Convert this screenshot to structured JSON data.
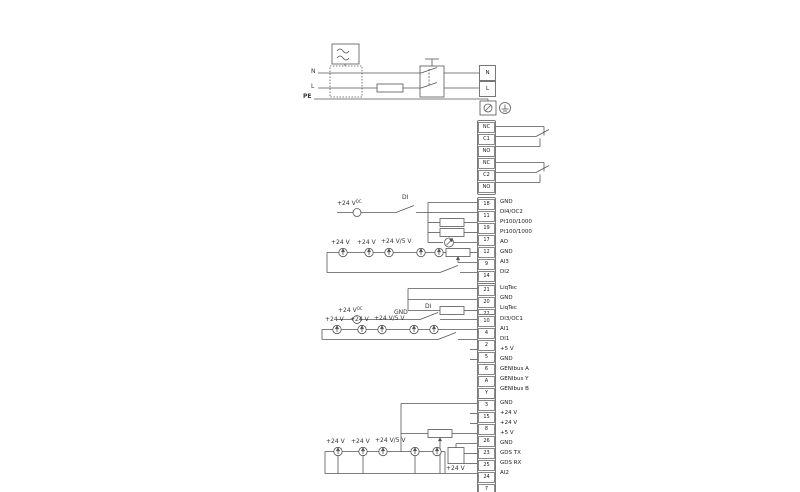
{
  "colors": {
    "line": "#555555",
    "box_border": "#7a7a7a",
    "text": "#222222",
    "background": "#ffffff"
  },
  "power": {
    "label_n": "N",
    "label_l": "L",
    "label_pe": "PE",
    "terminal_n": "N",
    "terminal_l": "L"
  },
  "wire_labels": {
    "plus24": "+24 V",
    "oc": "OC",
    "di": "DI",
    "gnd": "GND",
    "plus24_5": "+24 V/5 V"
  },
  "relays": {
    "g1": [
      {
        "id": "NC"
      },
      {
        "id": "C1"
      },
      {
        "id": "NO"
      }
    ],
    "g2": [
      {
        "id": "NC"
      },
      {
        "id": "C2"
      },
      {
        "id": "NO"
      }
    ]
  },
  "terminals": {
    "g3": [
      {
        "id": "18",
        "label": "GND"
      },
      {
        "id": "11",
        "label": "DI4/OC2"
      },
      {
        "id": "19",
        "label": "Pt100/1000"
      },
      {
        "id": "17",
        "label": "Pt100/1000"
      },
      {
        "id": "12",
        "label": "AO"
      },
      {
        "id": "9",
        "label": "GND"
      },
      {
        "id": "14",
        "label": "AI3"
      },
      {
        "id": "1",
        "label": "DI2"
      }
    ],
    "g4": [
      {
        "id": "21",
        "label": "LiqTec"
      },
      {
        "id": "20",
        "label": "GND"
      },
      {
        "id": "22",
        "label": "LiqTec"
      }
    ],
    "g5": [
      {
        "id": "10",
        "label": "DI3/OC1"
      },
      {
        "id": "4",
        "label": "AI1"
      },
      {
        "id": "2",
        "label": "DI1"
      },
      {
        "id": "5",
        "label": "+5 V"
      },
      {
        "id": "6",
        "label": "GND"
      },
      {
        "id": "A",
        "label": "GENIbus A"
      },
      {
        "id": "Y",
        "label": "GENIbus Y"
      },
      {
        "id": "B",
        "label": "GENIbus B"
      }
    ],
    "g6": [
      {
        "id": "3",
        "label": "GND"
      },
      {
        "id": "15",
        "label": "+24 V"
      },
      {
        "id": "8",
        "label": "+24 V"
      },
      {
        "id": "26",
        "label": "+5 V"
      },
      {
        "id": "23",
        "label": "GND"
      },
      {
        "id": "25",
        "label": "GDS TX"
      },
      {
        "id": "24",
        "label": "GDS RX"
      },
      {
        "id": "7",
        "label": "AI2"
      }
    ]
  }
}
